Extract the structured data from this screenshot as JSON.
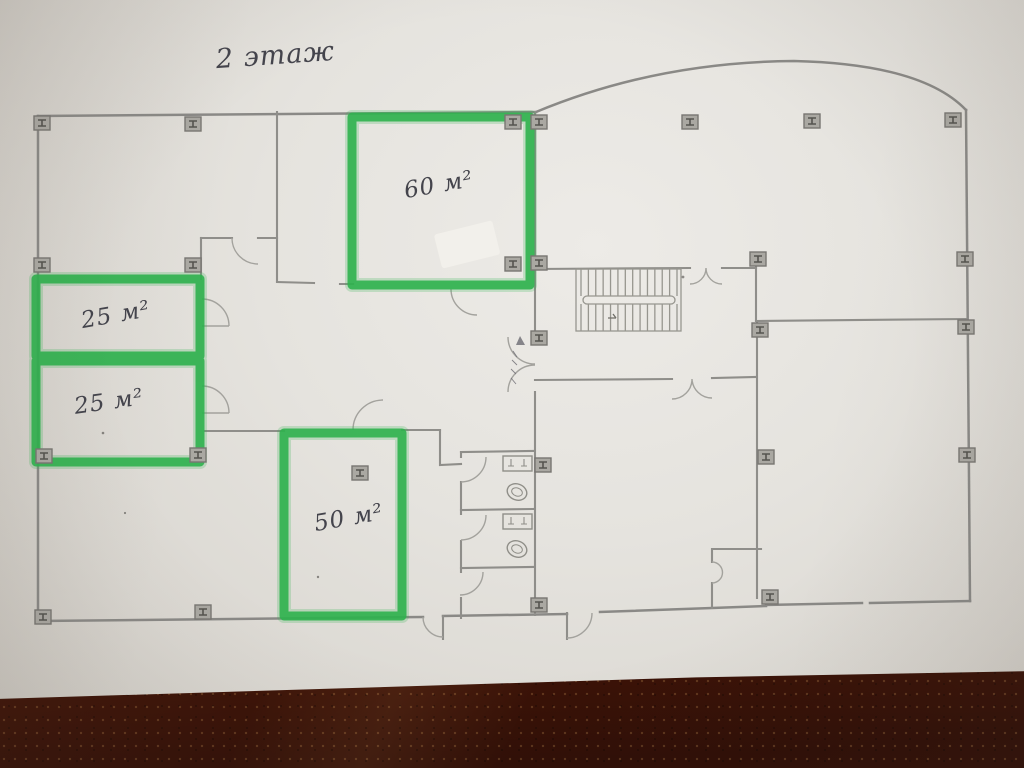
{
  "photo": {
    "description_colors": {
      "marker_green": "#2fb14e",
      "wall_gray": "#8b8a86",
      "pencil_dark": "#44444c",
      "paper_light": "#e8e6e1",
      "wood_brown": "#5e2714"
    }
  },
  "plan": {
    "floor_title": "2 этаж",
    "rooms": [
      {
        "id": "room-60",
        "label": "60 м²"
      },
      {
        "id": "room-25-upper",
        "label": "25 м²"
      },
      {
        "id": "room-25-lower",
        "label": "25 м²"
      },
      {
        "id": "room-50",
        "label": "50 м²"
      }
    ],
    "column_symbol": "I-beam",
    "columns": [
      [
        42,
        123
      ],
      [
        193,
        124
      ],
      [
        513,
        122
      ],
      [
        539,
        122
      ],
      [
        690,
        122
      ],
      [
        812,
        121
      ],
      [
        953,
        120
      ],
      [
        42,
        265
      ],
      [
        193,
        265
      ],
      [
        513,
        264
      ],
      [
        539,
        263
      ],
      [
        758,
        259
      ],
      [
        965,
        259
      ],
      [
        539,
        338
      ],
      [
        760,
        330
      ],
      [
        966,
        327
      ],
      [
        44,
        456
      ],
      [
        198,
        455
      ],
      [
        360,
        473
      ],
      [
        543,
        465
      ],
      [
        766,
        457
      ],
      [
        967,
        455
      ],
      [
        43,
        617
      ],
      [
        203,
        612
      ],
      [
        539,
        605
      ],
      [
        770,
        597
      ]
    ],
    "stairs": {
      "flights": 2,
      "treads_per_flight": 14
    },
    "fixtures": {
      "sinks": 2,
      "toilets": 2
    }
  }
}
